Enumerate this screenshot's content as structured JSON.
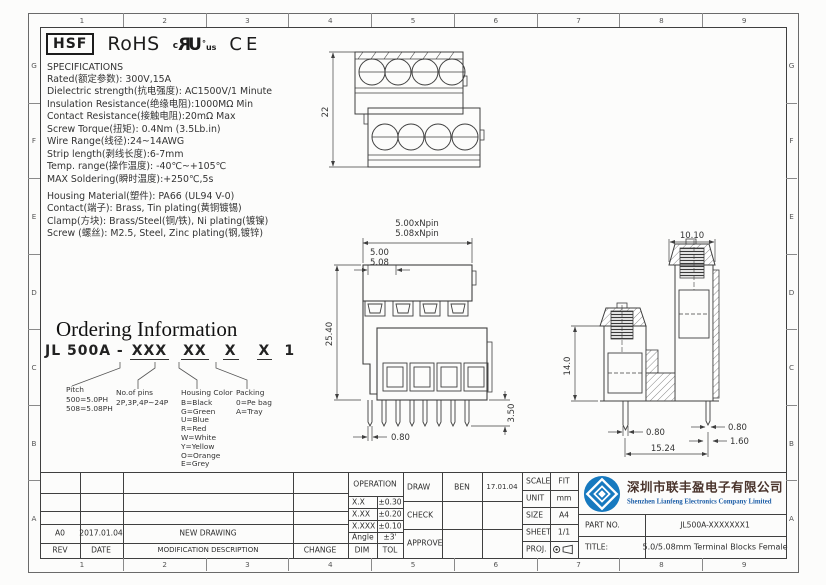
{
  "frame": {
    "cols": [
      "1",
      "2",
      "3",
      "4",
      "5",
      "6",
      "7",
      "8",
      "9"
    ],
    "rows": [
      "G",
      "F",
      "E",
      "D",
      "C",
      "B",
      "A"
    ]
  },
  "marks": {
    "hsf": "HSF",
    "rohs": "RoHS",
    "ul_c": "c",
    "ul_r": "R",
    "ul_u": "U",
    "ul_deg": "°",
    "ul_us": "us",
    "ce": "CE"
  },
  "specs": {
    "title": "SPECIFICATIONS",
    "lines": [
      "Rated(额定参数): 300V,15A",
      "Dielectric strength(抗电强度): AC1500V/1 Minute",
      "Insulation Resistance(绝缘电阻):1000MΩ Min",
      "Contact Resistance(接触电阻):20mΩ Max",
      "Screw Torque(扭矩): 0.4Nm (3.5Lb.in)",
      "Wire Range(线径):24~14AWG",
      "Strip length(剥线长度):6-7mm",
      "Temp. range(操作温度): -40℃~+105℃",
      "MAX Soldering(瞬时温度):+250℃,5s"
    ]
  },
  "materials": {
    "lines": [
      "Housing Material(塑件): PA66 (UL94 V-0)",
      "Contact(端子): Brass, Tin plating(黄铜镀锡)",
      "Clamp(方块): Brass/Steel(铜/铁), Ni plating(镀镍)",
      "Screw (螺丝): M2.5, Steel, Zinc plating(钢,镀锌)"
    ]
  },
  "ordering": {
    "title": "Ordering Information",
    "code_prefix": "JL 500A -",
    "code_groups": [
      "XXX",
      "XX",
      "X",
      "X"
    ],
    "code_suffix": "1",
    "pitch": {
      "title": "Pitch",
      "lines": [
        "500=5.0PH",
        "508=5.08PH"
      ]
    },
    "pins": {
      "title": "No.of pins",
      "lines": [
        "2P,3P,4P~24P"
      ]
    },
    "housing": {
      "title": "Housing Color",
      "lines": [
        "B=Black",
        "G=Green",
        "U=Blue",
        "R=Red",
        "W=White",
        "Y=Yellow",
        "O=Orange",
        "E=Grey"
      ]
    },
    "packing": {
      "title": "Packing",
      "lines": [
        "0=Pe bag",
        "A=Tray"
      ]
    }
  },
  "drawings": {
    "top_view": {
      "height": "22"
    },
    "front_view": {
      "pitch_total_1": "5.00xNpin",
      "pitch_total_2": "5.08xNpin",
      "pitch_1": "5.00",
      "pitch_2": "5.08",
      "height": "25.40",
      "pin_w": "0.80",
      "pin_len": "3.50"
    },
    "side_view": {
      "top_width": "10.10",
      "height": "14.0",
      "pin_w_left": "0.80",
      "pin_w_right": "0.80",
      "pin_t": "1.60",
      "row_pitch": "15.24"
    }
  },
  "titleblock": {
    "revision": {
      "row": {
        "rev": "A0",
        "date": "2017.01.04",
        "desc": "NEW DRAWING",
        "change": ""
      },
      "headers": [
        "REV",
        "DATE",
        "MODIFICATION DESCRIPTION",
        "CHANGE"
      ]
    },
    "tolerance": {
      "title": "OPERATION",
      "rows": [
        [
          "X.X",
          "±0.30"
        ],
        [
          "X.XX",
          "±0.20"
        ],
        [
          "X.XXX",
          "±0.10"
        ],
        [
          "Angle",
          "±3'"
        ]
      ],
      "footer": [
        "DIM",
        "TOL"
      ]
    },
    "signoff": {
      "rows": [
        [
          "DRAW",
          "BEN",
          "17.01.04"
        ],
        [
          "CHECK",
          "",
          ""
        ],
        [
          "APPROVE",
          "",
          ""
        ]
      ]
    },
    "meta": {
      "rows": [
        [
          "SCALE",
          "FIT"
        ],
        [
          "UNIT",
          "mm"
        ],
        [
          "SIZE",
          "A4"
        ],
        [
          "SHEET",
          "1/1"
        ]
      ],
      "proj_label": "PROJ."
    },
    "company": {
      "cn": "深圳市联丰盈电子有限公司",
      "en": "Shenzhen Lianfeng Electronics Company Limited"
    },
    "part": {
      "label": "PART NO.",
      "value": "JL500A-XXXXXXX1"
    },
    "title": {
      "label": "TITLE:",
      "value": "5.0/5.08mm Terminal Blocks Female"
    }
  },
  "colors": {
    "line": "#3f3f3f",
    "logo_blue": "#1679bf",
    "company_cn": "#4a342c",
    "company_en": "#1e5fa8"
  }
}
